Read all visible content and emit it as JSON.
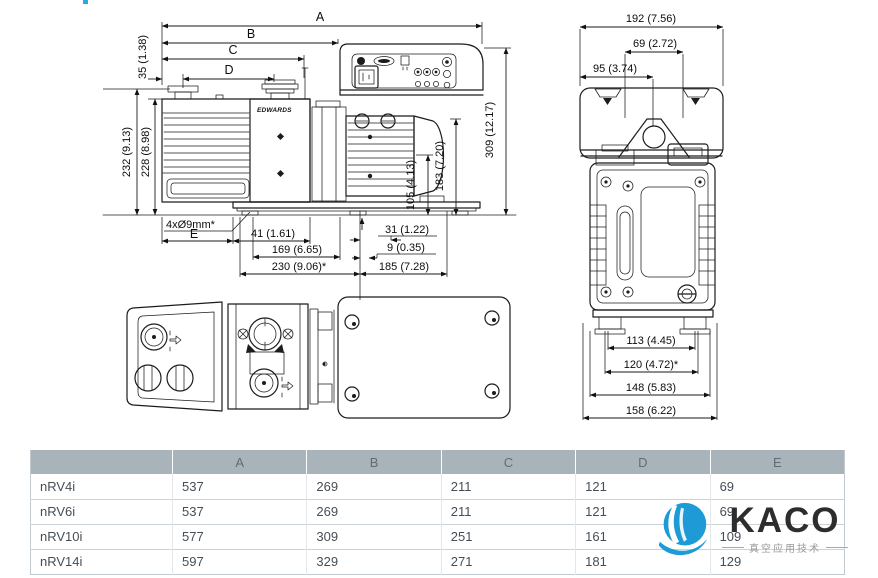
{
  "side_view": {
    "labels": {
      "A": "A",
      "B": "B",
      "C": "C",
      "D": "D",
      "E": "E",
      "h35": "35 (1.38)",
      "h232": "232 (9.13)",
      "h228": "228 (8.98)",
      "holes": "4xØ9mm*",
      "d41": "41 (1.61)",
      "d169": "169 (6.65)",
      "d230": "230 (9.06)*",
      "d31": "31 (1.22)",
      "d9": "9 (0.35)",
      "d185": "185 (7.28)",
      "d105": "105 (4.13)",
      "d183": "183 (7.20)",
      "d309": "309 (12.17)",
      "brand": "EDWARDS"
    }
  },
  "end_view": {
    "labels": {
      "d192": "192 (7.56)",
      "d69": "69 (2.72)",
      "d95": "95 (3.74)",
      "d113": "113 (4.45)",
      "d120": "120 (4.72)*",
      "d148": "148 (5.83)",
      "d158": "158 (6.22)"
    }
  },
  "table": {
    "headers": [
      "",
      "A",
      "B",
      "C",
      "D",
      "E"
    ],
    "rows": [
      {
        "model": "nRV4i",
        "A": "537",
        "B": "269",
        "C": "211",
        "D": "121",
        "E": "69"
      },
      {
        "model": "nRV6i",
        "A": "537",
        "B": "269",
        "C": "211",
        "D": "121",
        "E": "69"
      },
      {
        "model": "nRV10i",
        "A": "577",
        "B": "309",
        "C": "251",
        "D": "161",
        "E": "109"
      },
      {
        "model": "nRV14i",
        "A": "597",
        "B": "329",
        "C": "271",
        "D": "181",
        "E": "129"
      }
    ]
  },
  "logo": {
    "name": "KACO",
    "subtitle": "真空应用技术",
    "brand_color": "#1e9ad6"
  },
  "accent_dot_color": "#29abe2"
}
